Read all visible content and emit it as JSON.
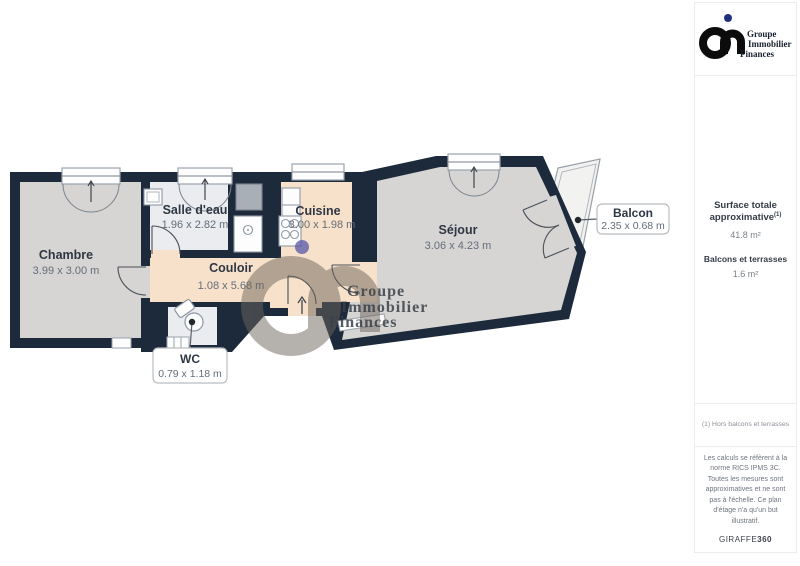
{
  "watermark": {
    "line1": "Groupe",
    "line2": "Immobilier",
    "line3": "Finances"
  },
  "logo": {
    "line1": "Groupe",
    "line2": "Immobilier",
    "line3": "Finances"
  },
  "rooms": {
    "chambre": {
      "name": "Chambre",
      "dims": "3.99 x 3.00 m"
    },
    "salle_deau": {
      "name": "Salle d'eau",
      "dims": "1.96 x 2.82 m"
    },
    "cuisine": {
      "name": "Cuisine",
      "dims": "3.00 x 1.98 m"
    },
    "couloir": {
      "name": "Couloir",
      "dims": "1.08 x 5.68 m"
    },
    "sejour": {
      "name": "Séjour",
      "dims": "3.06 x 4.23 m"
    },
    "wc": {
      "name": "WC",
      "dims": "0.79 x 1.18 m"
    },
    "balcon": {
      "name": "Balcon",
      "dims": "2.35 x 0.68 m"
    }
  },
  "summary": {
    "surface_label": "Surface totale approximative",
    "surface_sup": "(1)",
    "surface_value": "41.8 m²",
    "balcony_label": "Balcons et terrasses",
    "balcony_value": "1.6 m²",
    "footnote": "(1) Hors balcons et terrasses",
    "disclaimer": "Les calculs se réfèrent à la norme RICS IPMS 3C. Toutes les mesures sont approximatives et ne sont pas à l'échelle. Ce plan d'étage n'a qu'un but illustratif.",
    "brand": "GIRAFFE",
    "brand_suffix": "360"
  },
  "colors": {
    "wall": "#1c2a3c",
    "floor_gray": "#d6d5d3",
    "floor_light": "#eaecef",
    "floor_peach": "#f7e1ca",
    "logo_blue": "#20307f",
    "watermark_dot": "#5555a8"
  }
}
